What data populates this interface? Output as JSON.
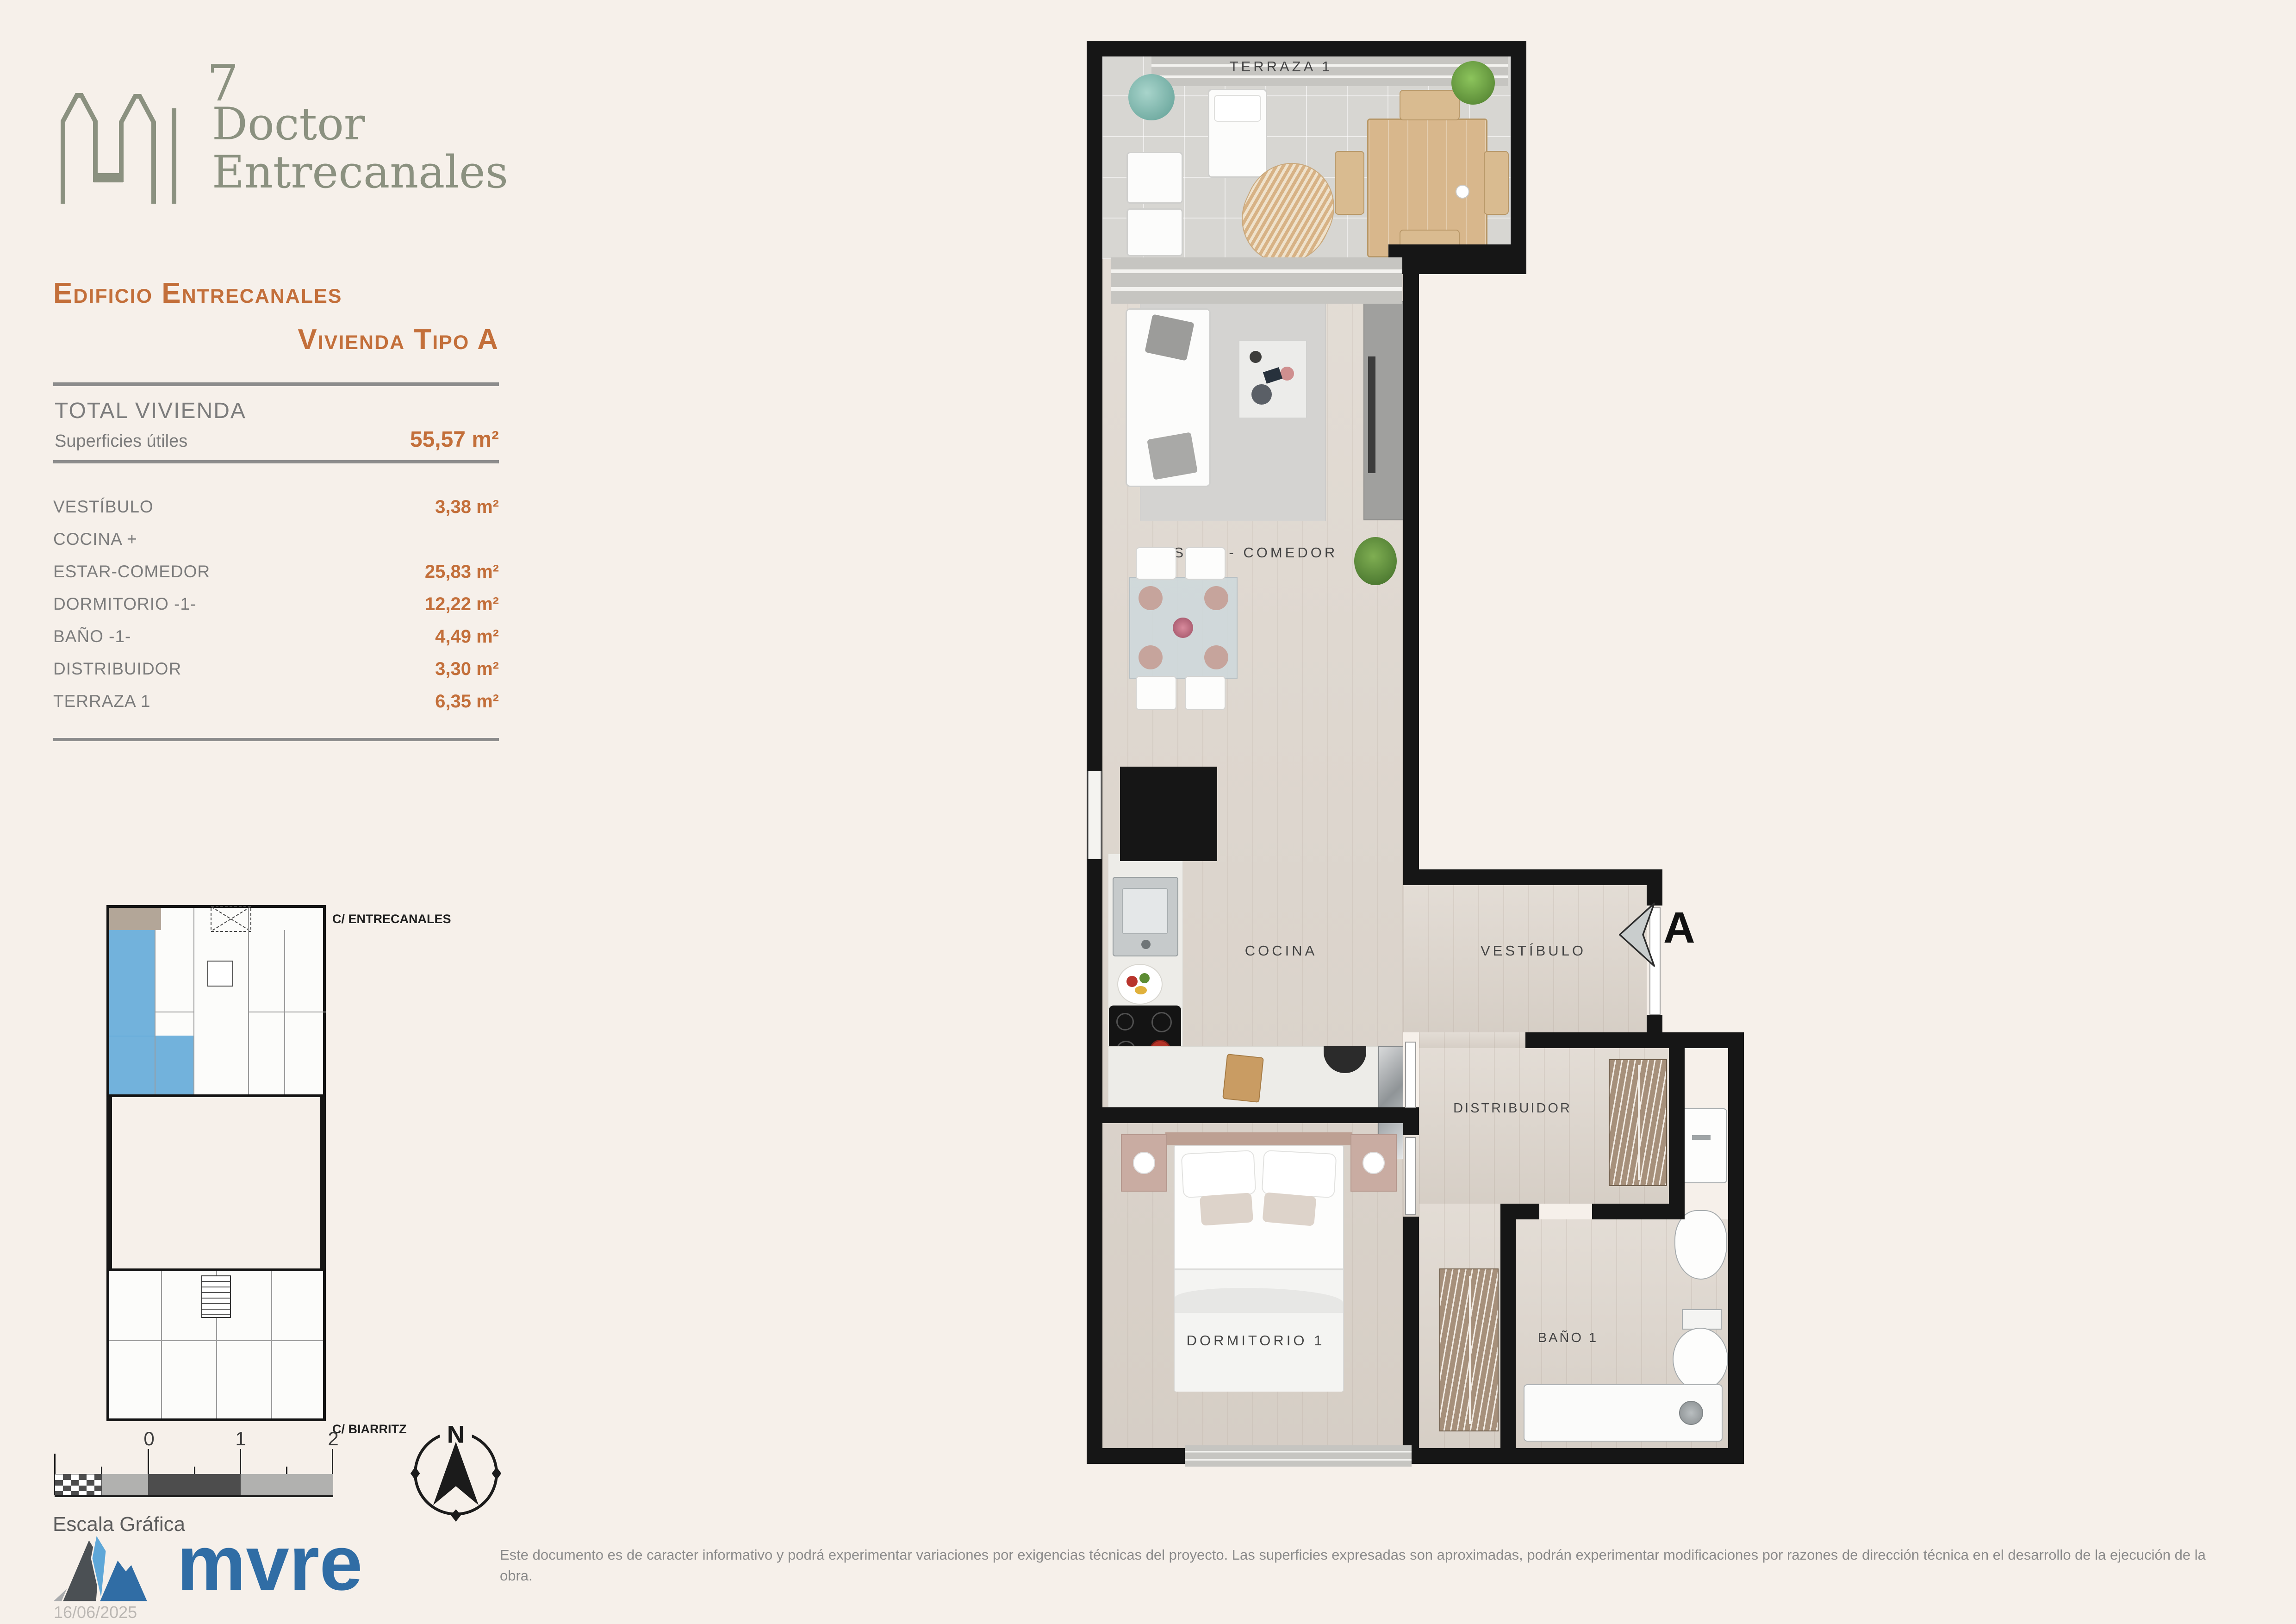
{
  "brand": {
    "number": "7",
    "line1": "Doctor",
    "line2": "Entrecanales"
  },
  "header": {
    "building": "Edificio Entrecanales",
    "unit": "Vivienda Tipo A"
  },
  "summary": {
    "total_label": "TOTAL VIVIENDA",
    "areas_label": "Superficies útiles",
    "total_value": "55,57 m²"
  },
  "rooms": [
    {
      "label": "VESTÍBULO",
      "value": "3,38 m²"
    },
    {
      "label": "COCINA +",
      "value": ""
    },
    {
      "label": "ESTAR-COMEDOR",
      "value": "25,83 m²"
    },
    {
      "label": "DORMITORIO -1-",
      "value": "12,22 m²"
    },
    {
      "label": "BAÑO -1-",
      "value": "4,49 m²"
    },
    {
      "label": "DISTRIBUIDOR",
      "value": "3,30 m²"
    },
    {
      "label": "TERRAZA 1",
      "value": "6,35 m²"
    }
  ],
  "floor_plan": {
    "labels": {
      "terraza": "TERRAZA 1",
      "estar": "ESTAR - COMEDOR",
      "cocina": "COCINA",
      "vestibulo": "VESTÍBULO",
      "distribuidor": "DISTRIBUIDOR",
      "dormitorio": "DORMITORIO 1",
      "bano": "BAÑO 1"
    },
    "entry_marker": "A"
  },
  "key_plan": {
    "street_top": "C/ ENTRECANALES",
    "street_bottom": "C/ BIARRITZ"
  },
  "scale_bar": {
    "ticks": [
      "0",
      "1",
      "2"
    ],
    "label": "Escala Gráfica"
  },
  "compass": {
    "north": "N"
  },
  "footer": {
    "logo": "mvre",
    "date": "16/06/2025",
    "disclaimer": "Este documento es de caracter informativo y podrá experimentar variaciones por exigencias técnicas del proyecto. Las superficies expresadas son aproximadas, podrán experimentar modificaciones por razones de dirección técnica en el desarrollo de la ejecución de la obra."
  },
  "colors": {
    "accent": "#c36f3a",
    "text_gray": "#7c7c7c",
    "sage": "#8b9180",
    "brand_blue": "#306da5",
    "background": "#f6f0ea",
    "wall": "#161616",
    "highlight_blue": "#66abd9"
  }
}
